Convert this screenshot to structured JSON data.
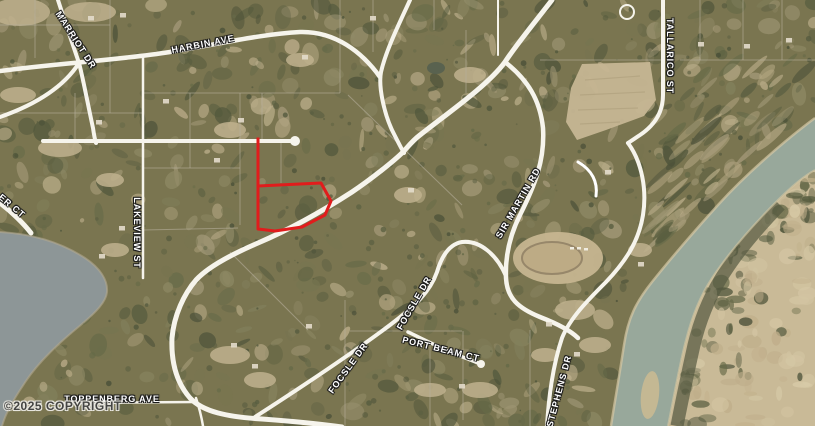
{
  "map": {
    "copyright": {
      "text": "©2025 COPYRIGHT"
    },
    "labels": [
      {
        "text": "MARRIOT DR",
        "x": 76,
        "y": 40,
        "rot": 57
      },
      {
        "text": "HARBIN AVE",
        "x": 203,
        "y": 44,
        "rot": -11
      },
      {
        "text": "TALLARICO ST",
        "x": 670,
        "y": 56,
        "rot": 90
      },
      {
        "text": "ER CT",
        "x": 12,
        "y": 206,
        "rot": 40
      },
      {
        "text": "LAKEVIEW ST",
        "x": 137,
        "y": 233,
        "rot": 90
      },
      {
        "text": "SIR MARTIN RD",
        "x": 518,
        "y": 203,
        "rot": -60
      },
      {
        "text": "FOCSLE DR",
        "x": 414,
        "y": 303,
        "rot": -60
      },
      {
        "text": "FOCSLE DR",
        "x": 348,
        "y": 368,
        "rot": -54
      },
      {
        "text": "PORT BEAM CT",
        "x": 441,
        "y": 349,
        "rot": 14
      },
      {
        "text": "STEPHENS DR",
        "x": 559,
        "y": 391,
        "rot": -75
      },
      {
        "text": "TOPPENBERG AVE",
        "x": 112,
        "y": 399,
        "rot": 0
      }
    ],
    "parcel": {
      "color": "#e11c1c",
      "stem_path": "M 258 139 L 258 186",
      "body_path": "M 258 186 L 321 183 L 331 201 L 325 215 L 302 227 L 275 231 L 258 229 Z"
    },
    "colors": {
      "terrain_base": "#7a7550",
      "road": "#f6f4ec",
      "thin_road": "#e9e5d8",
      "lot_line": "#b6af9c",
      "lake": "#8d9697",
      "river": "#98a89b",
      "sand": "#c9ba97",
      "shore": "#b2a98f",
      "bank_sand": "#d6c8a4",
      "riparian": "#545840"
    },
    "water": {
      "lake_path": "M 0 232 C 35 234 62 243 85 258 C 100 268 108 280 107 292 C 106 302 96 312 82 324 C 60 342 38 362 24 384 C 14 399 6 412 2 426 L 0 426 Z",
      "lake_shore": "M 0 232 C 35 234 62 243 85 258 C 100 268 108 280 107 292 C 106 302 96 312 82 324 C 60 342 38 362 24 384 C 14 399 6 412 2 426",
      "river_path": "M 815 118 C 788 138 748 172 718 205 C 690 236 668 262 652 282 C 636 302 628 318 624 345 C 620 372 615 400 611 426 L 668 426 C 674 396 680 362 686 340 C 692 316 700 296 712 278 C 728 254 752 226 778 200 C 792 186 804 176 815 170 Z",
      "river_left_bank": "M 815 118 C 788 138 748 172 718 205 C 690 236 668 262 652 282 C 636 302 628 318 624 345 C 620 372 615 400 611 426",
      "river_right_bank": "M 815 170 C 804 176 792 186 778 200 C 752 226 728 254 712 278 C 700 296 692 316 686 340 C 680 362 674 396 668 426",
      "sand_path": "M 815 170 C 804 176 792 186 778 200 C 752 226 728 254 712 278 C 700 296 692 316 686 340 C 680 362 674 396 668 426 L 815 426 Z",
      "riparian_strip": "M 780 205 C 756 230 734 256 720 280 C 708 300 700 320 694 345 C 688 372 682 400 677 426"
    },
    "roads": [
      {
        "name": "main-road",
        "d": "M 552 0 C 535 22 516 45 505 62 C 488 85 452 110 420 135 C 412 141 407 148 403 152 C 394 161 370 180 352 192 C 335 203 300 225 258 243 C 230 255 207 268 196 280 C 184 294 174 315 172 338 C 171 362 176 382 190 398 C 203 412 228 417 262 419 C 290 421 320 424 342 427",
        "w": 5
      },
      {
        "name": "sir-martin-rd",
        "d": "M 505 62 C 528 80 540 100 543 128 C 545 160 535 185 520 215 C 510 235 505 255 506 278 C 507 298 518 308 540 317 C 558 324 571 331 578 338",
        "w": 4.5
      },
      {
        "name": "bluff-stephens-dr",
        "d": "M 628 143 C 642 162 647 190 643 215 C 639 240 627 260 606 282 C 588 300 570 318 562 338 C 554 362 549 392 547 426",
        "w": 4
      },
      {
        "name": "harbin-ave",
        "d": "M 0 71 C 60 63 120 60 170 52 C 215 45 260 34 300 32 C 335 31 362 52 380 77",
        "w": 4.5
      },
      {
        "name": "north-road",
        "d": "M 410 0 C 400 22 386 50 381 72 C 378 88 385 115 392 130 C 397 140 401 148 404 153",
        "w": 4
      },
      {
        "name": "marriot-dr",
        "d": "M 58 0 C 66 25 74 48 79 63 C 83 78 88 105 93 128 C 94 135 95 140 96 143",
        "w": 4
      },
      {
        "name": "marriot-dr-west",
        "d": "M 79 63 C 65 85 40 103 0 117",
        "w": 4
      },
      {
        "name": "culdesac-road",
        "d": "M 43 141 L 290 141",
        "w": 4
      },
      {
        "name": "tallarico-st",
        "d": "M 663 0 L 663 95 C 663 112 655 125 640 135 L 628 143",
        "w": 4
      },
      {
        "name": "focsle-dr",
        "d": "M 255 417 C 300 388 350 355 390 325 C 415 306 430 292 437 272 C 442 255 450 244 462 242 C 480 240 497 255 506 276",
        "w": 4
      },
      {
        "name": "port-beam-ct",
        "d": "M 408 332 C 425 340 448 352 468 359 L 478 363",
        "w": 3.5
      },
      {
        "name": "er-ct-road",
        "d": "M 0 203 C 12 212 24 224 31 233",
        "w": 5
      },
      {
        "name": "toppenberg-ave",
        "d": "M 56 403 L 196 402",
        "w": 2.5
      },
      {
        "name": "lakeview-st",
        "d": "M 143 57 L 143 278",
        "w": 2.5
      },
      {
        "name": "south-spur",
        "d": "M 196 398 C 200 410 202 420 203 426",
        "w": 2.5
      },
      {
        "name": "top-minor-road",
        "d": "M 498 0 L 498 55",
        "w": 2
      },
      {
        "name": "driveway-hook",
        "d": "M 578 162 C 592 170 598 182 596 196",
        "w": 3,
        "c": "#ffffff"
      }
    ],
    "road_circles": [
      {
        "cx": 295,
        "cy": 141,
        "r": 5,
        "fill": true
      },
      {
        "cx": 481,
        "cy": 364,
        "r": 4,
        "fill": true
      },
      {
        "cx": 627,
        "cy": 12,
        "r": 7,
        "fill": false
      }
    ],
    "lot_lines": [
      [
        35,
        0,
        35,
        58
      ],
      [
        110,
        0,
        110,
        113
      ],
      [
        75,
        93,
        75,
        140
      ],
      [
        190,
        93,
        190,
        168
      ],
      [
        240,
        93,
        240,
        225
      ],
      [
        281,
        141,
        281,
        183
      ],
      [
        262,
        93,
        262,
        139
      ],
      [
        340,
        0,
        340,
        93
      ],
      [
        373,
        0,
        373,
        52
      ],
      [
        434,
        0,
        434,
        30
      ],
      [
        466,
        30,
        466,
        93
      ],
      [
        700,
        0,
        700,
        60
      ],
      [
        743,
        0,
        743,
        60
      ],
      [
        782,
        0,
        782,
        60
      ],
      [
        0,
        25,
        110,
        25
      ],
      [
        0,
        113,
        143,
        113
      ],
      [
        143,
        93,
        340,
        93
      ],
      [
        143,
        168,
        240,
        168
      ],
      [
        540,
        60,
        662,
        60
      ],
      [
        680,
        60,
        815,
        60
      ],
      [
        348,
        95,
        462,
        205
      ],
      [
        230,
        252,
        308,
        330
      ],
      [
        345,
        300,
        345,
        426
      ],
      [
        430,
        345,
        430,
        426
      ],
      [
        350,
        331,
        462,
        331
      ],
      [
        463,
        331,
        463,
        420
      ],
      [
        530,
        330,
        530,
        426
      ],
      [
        143,
        230,
        238,
        228
      ]
    ],
    "field_polygon": "582,64 650,62 656,100 644,116 606,130 577,140 566,122 571,88",
    "gravel_pit": {
      "cx": 558,
      "cy": 258,
      "rx": 45,
      "ry": 26
    }
  }
}
